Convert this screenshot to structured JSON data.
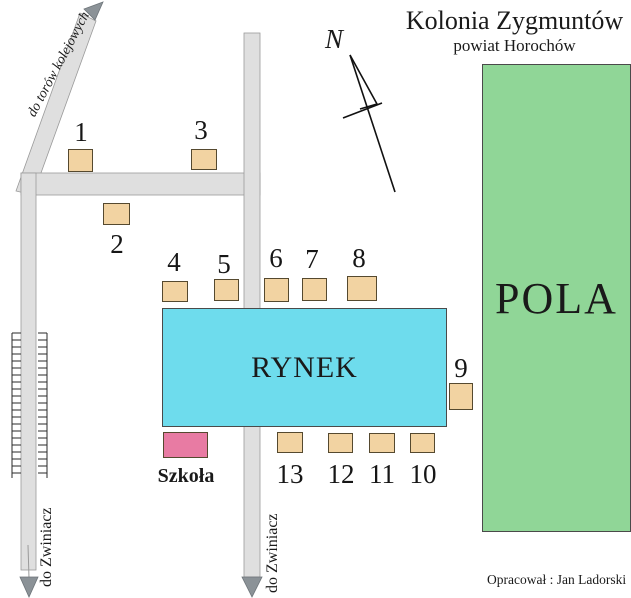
{
  "title": {
    "main": "Kolonia Zygmuntów",
    "sub": "powiat Horochów"
  },
  "compass": {
    "label": "N"
  },
  "areas": {
    "fields_label": "POLA",
    "market_label": "RYNEK",
    "school_label": "Szkoła"
  },
  "roads": {
    "railway_road_label": "do torów kolejowych",
    "west_road_label": "do Zwiniacz",
    "south_road_label": "do Zwiniacz"
  },
  "houses": [
    {
      "label": "1"
    },
    {
      "label": "2"
    },
    {
      "label": "3"
    },
    {
      "label": "4"
    },
    {
      "label": "5"
    },
    {
      "label": "6"
    },
    {
      "label": "7"
    },
    {
      "label": "8"
    },
    {
      "label": "9"
    },
    {
      "label": "10"
    },
    {
      "label": "11"
    },
    {
      "label": "12"
    },
    {
      "label": "13"
    }
  ],
  "credit": "Opracował : Jan Ladorski",
  "colors": {
    "fields": "#90d697",
    "market": "#6edced",
    "school": "#e87ba3",
    "house": "#f2d3a2",
    "road": "#dfdfdf",
    "arrow": "#8b9297"
  }
}
